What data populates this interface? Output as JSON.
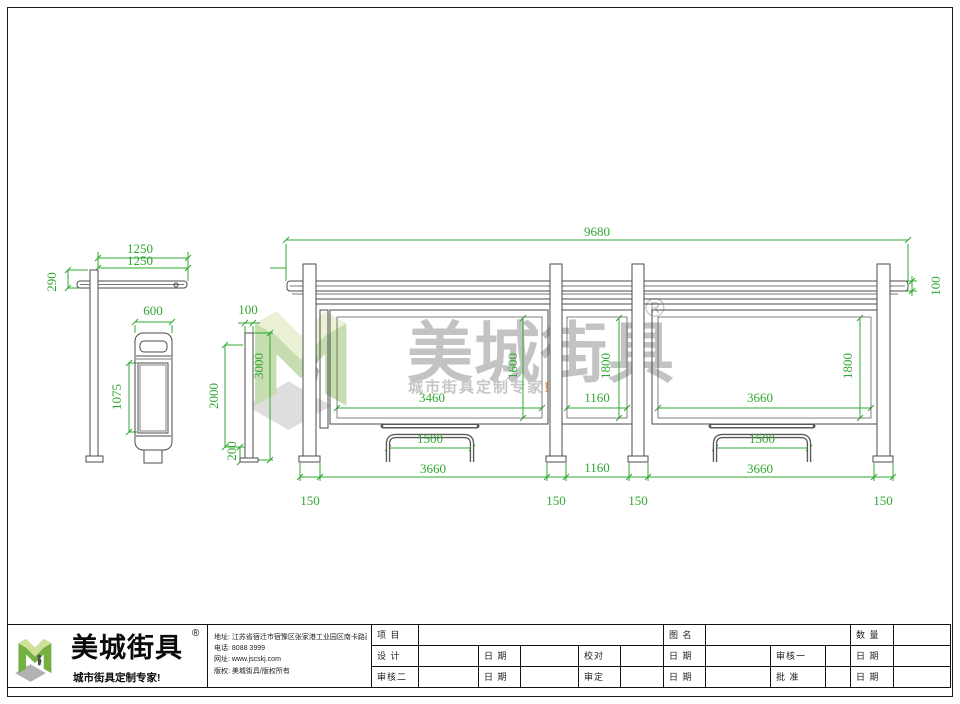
{
  "colors": {
    "dim": "#2fa82f",
    "line": "#4b4b4b",
    "logo_green": "#76b043",
    "logo_light": "#cfe09a",
    "logo_shadow": "#b2b2b2",
    "accent_orange": "#dd8f3c"
  },
  "watermark": {
    "brand": "美城街具",
    "registered": "®",
    "slogan": "城市街具定制专家",
    "slogan_suffix": "!"
  },
  "company": {
    "name": "美城街具",
    "registered": "®",
    "slogan": "城市街具定制专家!",
    "info": [
      {
        "label": "地址:",
        "value": "江苏省宿迁市宿豫区张家港工业园区南卡路西侧1号"
      },
      {
        "label": "电话:",
        "value": "8088 3999"
      },
      {
        "label": "网址:",
        "value": "www.jscskj.com"
      },
      {
        "label": "版权:",
        "value": "美城街具/版权所有"
      }
    ]
  },
  "titleblock": {
    "project": "项 目",
    "drawing_name": "图 名",
    "quantity": "数 量",
    "designer": "设 计",
    "date": "日 期",
    "checker": "校对",
    "reviewer1": "审核一",
    "reviewer2": "审核二",
    "approver": "审定",
    "ratifier": "批 准"
  },
  "drawing": {
    "dimensions": [
      {
        "label": "1250",
        "x": 140,
        "y": 249
      },
      {
        "label": "1250",
        "x": 140,
        "y": 261
      },
      {
        "label": "290",
        "x": 52,
        "y": 282,
        "rot": true
      },
      {
        "label": "600",
        "x": 153,
        "y": 311
      },
      {
        "label": "1075",
        "x": 117,
        "y": 397,
        "rot": true
      },
      {
        "label": "100",
        "x": 248,
        "y": 310
      },
      {
        "label": "3000",
        "x": 259,
        "y": 366,
        "rot": true
      },
      {
        "label": "2000",
        "x": 214,
        "y": 396,
        "rot": true
      },
      {
        "label": "200",
        "x": 232,
        "y": 451,
        "rot": true
      },
      {
        "label": "9680",
        "x": 597,
        "y": 232
      },
      {
        "label": "100",
        "x": 936,
        "y": 286,
        "rot": true
      },
      {
        "label": "1600",
        "x": 513,
        "y": 366,
        "rot": true
      },
      {
        "label": "3460",
        "x": 432,
        "y": 398
      },
      {
        "label": "1800",
        "x": 606,
        "y": 366,
        "rot": true
      },
      {
        "label": "1160",
        "x": 597,
        "y": 398
      },
      {
        "label": "1800",
        "x": 848,
        "y": 366,
        "rot": true
      },
      {
        "label": "3660",
        "x": 760,
        "y": 398
      },
      {
        "label": "1500",
        "x": 430,
        "y": 439
      },
      {
        "label": "1500",
        "x": 762,
        "y": 439
      },
      {
        "label": "3660",
        "x": 433,
        "y": 469
      },
      {
        "label": "1160",
        "x": 597,
        "y": 468
      },
      {
        "label": "3660",
        "x": 760,
        "y": 469
      },
      {
        "label": "150",
        "x": 310,
        "y": 501
      },
      {
        "label": "150",
        "x": 556,
        "y": 501
      },
      {
        "label": "150",
        "x": 638,
        "y": 501
      },
      {
        "label": "150",
        "x": 883,
        "y": 501
      }
    ]
  }
}
